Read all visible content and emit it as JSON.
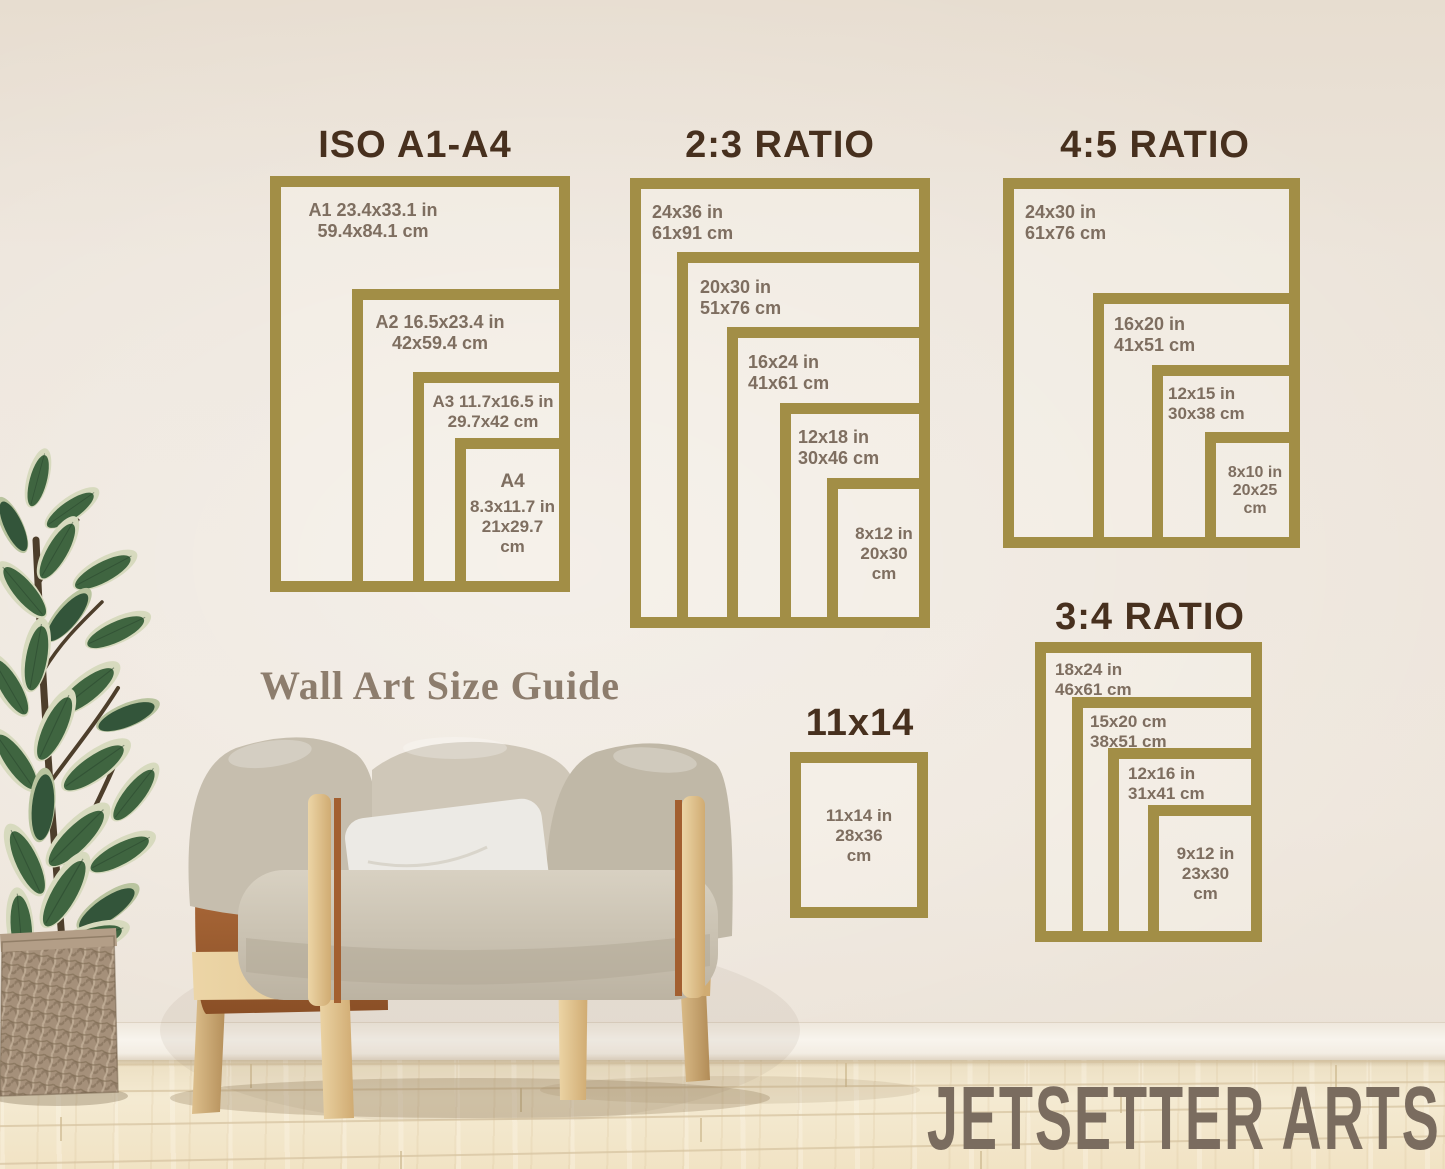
{
  "brand": "JETSETTER ARTS",
  "caption": "Wall Art Size Guide",
  "colors": {
    "frame_gold": "#a28e46",
    "heading_brown": "#47301e",
    "label_taupe": "#7e6e60",
    "wall_cream": "#ece4da",
    "caption_color": "#8d7d6d",
    "brand_color": "#7a6c5f"
  },
  "sections": {
    "iso": {
      "title": "ISO A1-A4",
      "frames": [
        {
          "l1": "A1 23.4x33.1 in",
          "l2": "59.4x84.1 cm"
        },
        {
          "l1": "A2 16.5x23.4 in",
          "l2": "42x59.4 cm"
        },
        {
          "l1": "A3 11.7x16.5 in",
          "l2": "29.7x42 cm"
        },
        {
          "name": "A4",
          "l1": "8.3x11.7 in",
          "l2": "21x29.7",
          "l3": "cm"
        }
      ]
    },
    "r23": {
      "title": "2:3 RATIO",
      "frames": [
        {
          "l1": "24x36 in",
          "l2": "61x91 cm"
        },
        {
          "l1": "20x30 in",
          "l2": "51x76 cm"
        },
        {
          "l1": "16x24 in",
          "l2": "41x61 cm"
        },
        {
          "l1": "12x18 in",
          "l2": "30x46 cm"
        },
        {
          "l1": "8x12 in",
          "l2": "20x30",
          "l3": "cm"
        }
      ]
    },
    "r45": {
      "title": "4:5 RATIO",
      "frames": [
        {
          "l1": "24x30 in",
          "l2": "61x76 cm"
        },
        {
          "l1": "16x20 in",
          "l2": "41x51 cm"
        },
        {
          "l1": "12x15 in",
          "l2": "30x38 cm"
        },
        {
          "l1": "8x10 in",
          "l2": "20x25",
          "l3": "cm"
        }
      ]
    },
    "r34": {
      "title": "3:4 RATIO",
      "frames": [
        {
          "l1": "18x24 in",
          "l2": "46x61 cm"
        },
        {
          "l1": "15x20 cm",
          "l2": "38x51 cm"
        },
        {
          "l1": "12x16 in",
          "l2": "31x41 cm"
        },
        {
          "l1": "9x12 in",
          "l2": "23x30",
          "l3": "cm"
        }
      ]
    },
    "s1114": {
      "title": "11x14",
      "frames": [
        {
          "l1": "11x14 in",
          "l2": "28x36",
          "l3": "cm"
        }
      ]
    }
  }
}
